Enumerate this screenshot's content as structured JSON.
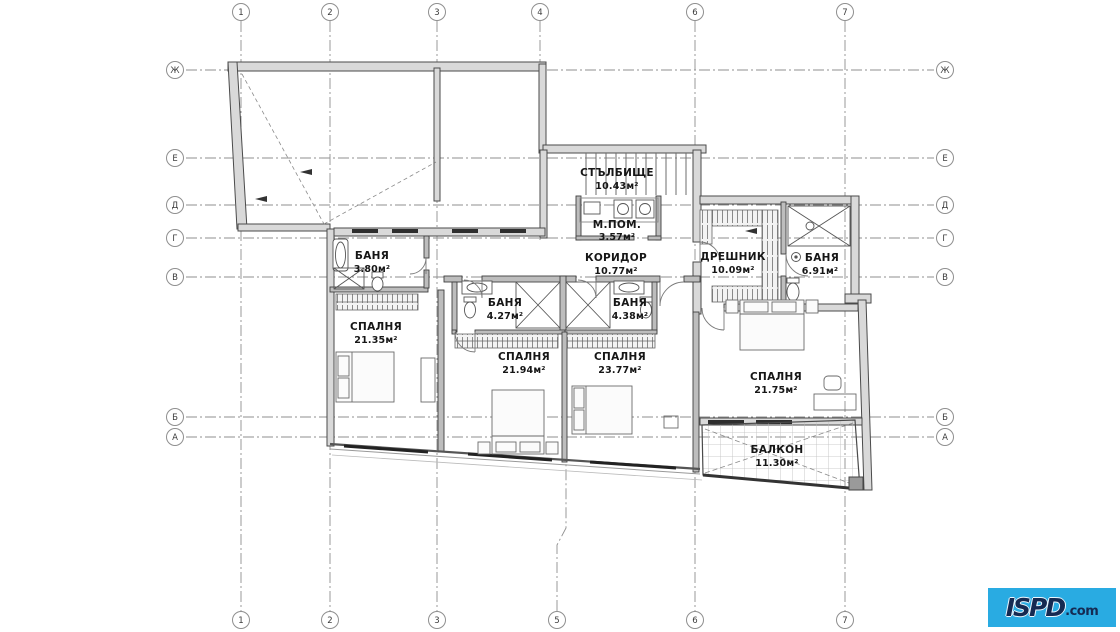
{
  "plan": {
    "rooms": [
      {
        "id": "stairwell",
        "name": "СТЪЛБИЩЕ",
        "area": "10.43м²"
      },
      {
        "id": "utility",
        "name": "М.ПОМ.",
        "area": "3.57м²"
      },
      {
        "id": "corridor",
        "name": "КОРИДОР",
        "area": "10.77м²"
      },
      {
        "id": "closet",
        "name": "ДРЕШНИК",
        "area": "10.09м²"
      },
      {
        "id": "bath-east",
        "name": "БАНЯ",
        "area": "6.91м²"
      },
      {
        "id": "bath-west",
        "name": "БАНЯ",
        "area": "3.80м²"
      },
      {
        "id": "bedroom-west",
        "name": "СПАЛНЯ",
        "area": "21.35м²"
      },
      {
        "id": "bath-mid-left",
        "name": "БАНЯ",
        "area": "4.27м²"
      },
      {
        "id": "bath-mid-right",
        "name": "БАНЯ",
        "area": "4.38м²"
      },
      {
        "id": "bedroom-mid-left",
        "name": "СПАЛНЯ",
        "area": "21.94м²"
      },
      {
        "id": "bedroom-mid-right",
        "name": "СПАЛНЯ",
        "area": "23.77м²"
      },
      {
        "id": "bedroom-east",
        "name": "СПАЛНЯ",
        "area": "21.75м²"
      },
      {
        "id": "balcony",
        "name": "БАЛКОН",
        "area": "11.30м²"
      }
    ],
    "grid": {
      "top": [
        {
          "label": "1"
        },
        {
          "label": "2"
        },
        {
          "label": "3"
        },
        {
          "label": "4"
        },
        {
          "label": "6"
        },
        {
          "label": "7"
        }
      ],
      "bottom": [
        {
          "label": "1"
        },
        {
          "label": "2"
        },
        {
          "label": "3"
        },
        {
          "label": "5"
        },
        {
          "label": "6"
        },
        {
          "label": "7"
        }
      ],
      "left": [
        {
          "label": "Ж"
        },
        {
          "label": "Е"
        },
        {
          "label": "Д"
        },
        {
          "label": "Г"
        },
        {
          "label": "В"
        },
        {
          "label": "Б"
        },
        {
          "label": "А"
        }
      ],
      "right": [
        {
          "label": "Ж"
        },
        {
          "label": "Е"
        },
        {
          "label": "Д"
        },
        {
          "label": "Г"
        },
        {
          "label": "В"
        },
        {
          "label": "Б"
        },
        {
          "label": "А"
        }
      ]
    },
    "colors": {
      "grid_line": "#8f8f8f",
      "wall": "#d9d9d9",
      "wall_edge": "#4a4a4a",
      "logo_bg": "#29abe2",
      "logo_text": "#152a52"
    }
  },
  "logo": {
    "main": "ISPD",
    "suffix": ".com"
  }
}
